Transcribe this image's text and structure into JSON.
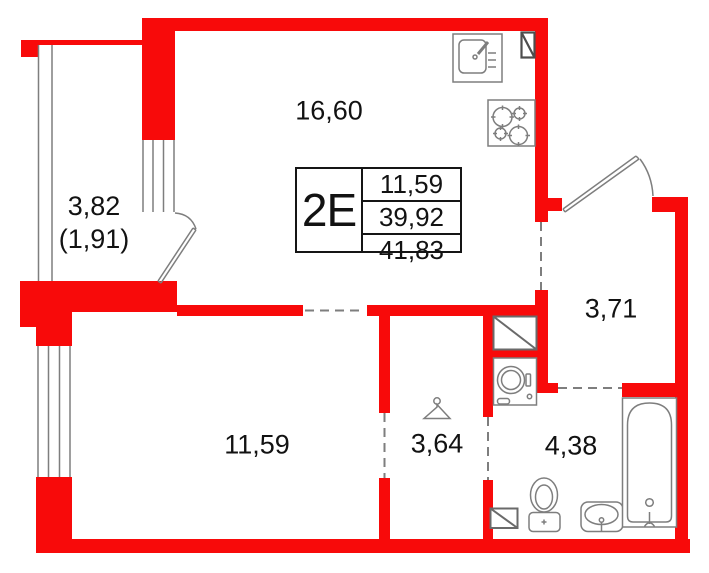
{
  "colors": {
    "wall": "#f80a0a",
    "line": "#7e7e7e",
    "vent": "#4d4d4d",
    "text": "#121212"
  },
  "unit": {
    "type_label": "2Е",
    "area_rows": [
      "11,59",
      "39,92",
      "41,83"
    ]
  },
  "rooms": {
    "kitchen_living": "16,60",
    "balcony": "3,82",
    "balcony_coeff": "(1,91)",
    "bedroom": "11,59",
    "dressing": "3,64",
    "bathroom": "4,38",
    "hallway": "3,71"
  },
  "icons": [
    "kitchen-sink-icon",
    "cooktop-icon",
    "vent-shaft-icon",
    "duct-box-icon",
    "washing-machine-icon",
    "hanger-icon",
    "toilet-icon",
    "washbasin-icon",
    "bathtub-icon",
    "vent-grille-icon",
    "balcony-door-swing-icon",
    "entrance-door-swing-icon"
  ]
}
